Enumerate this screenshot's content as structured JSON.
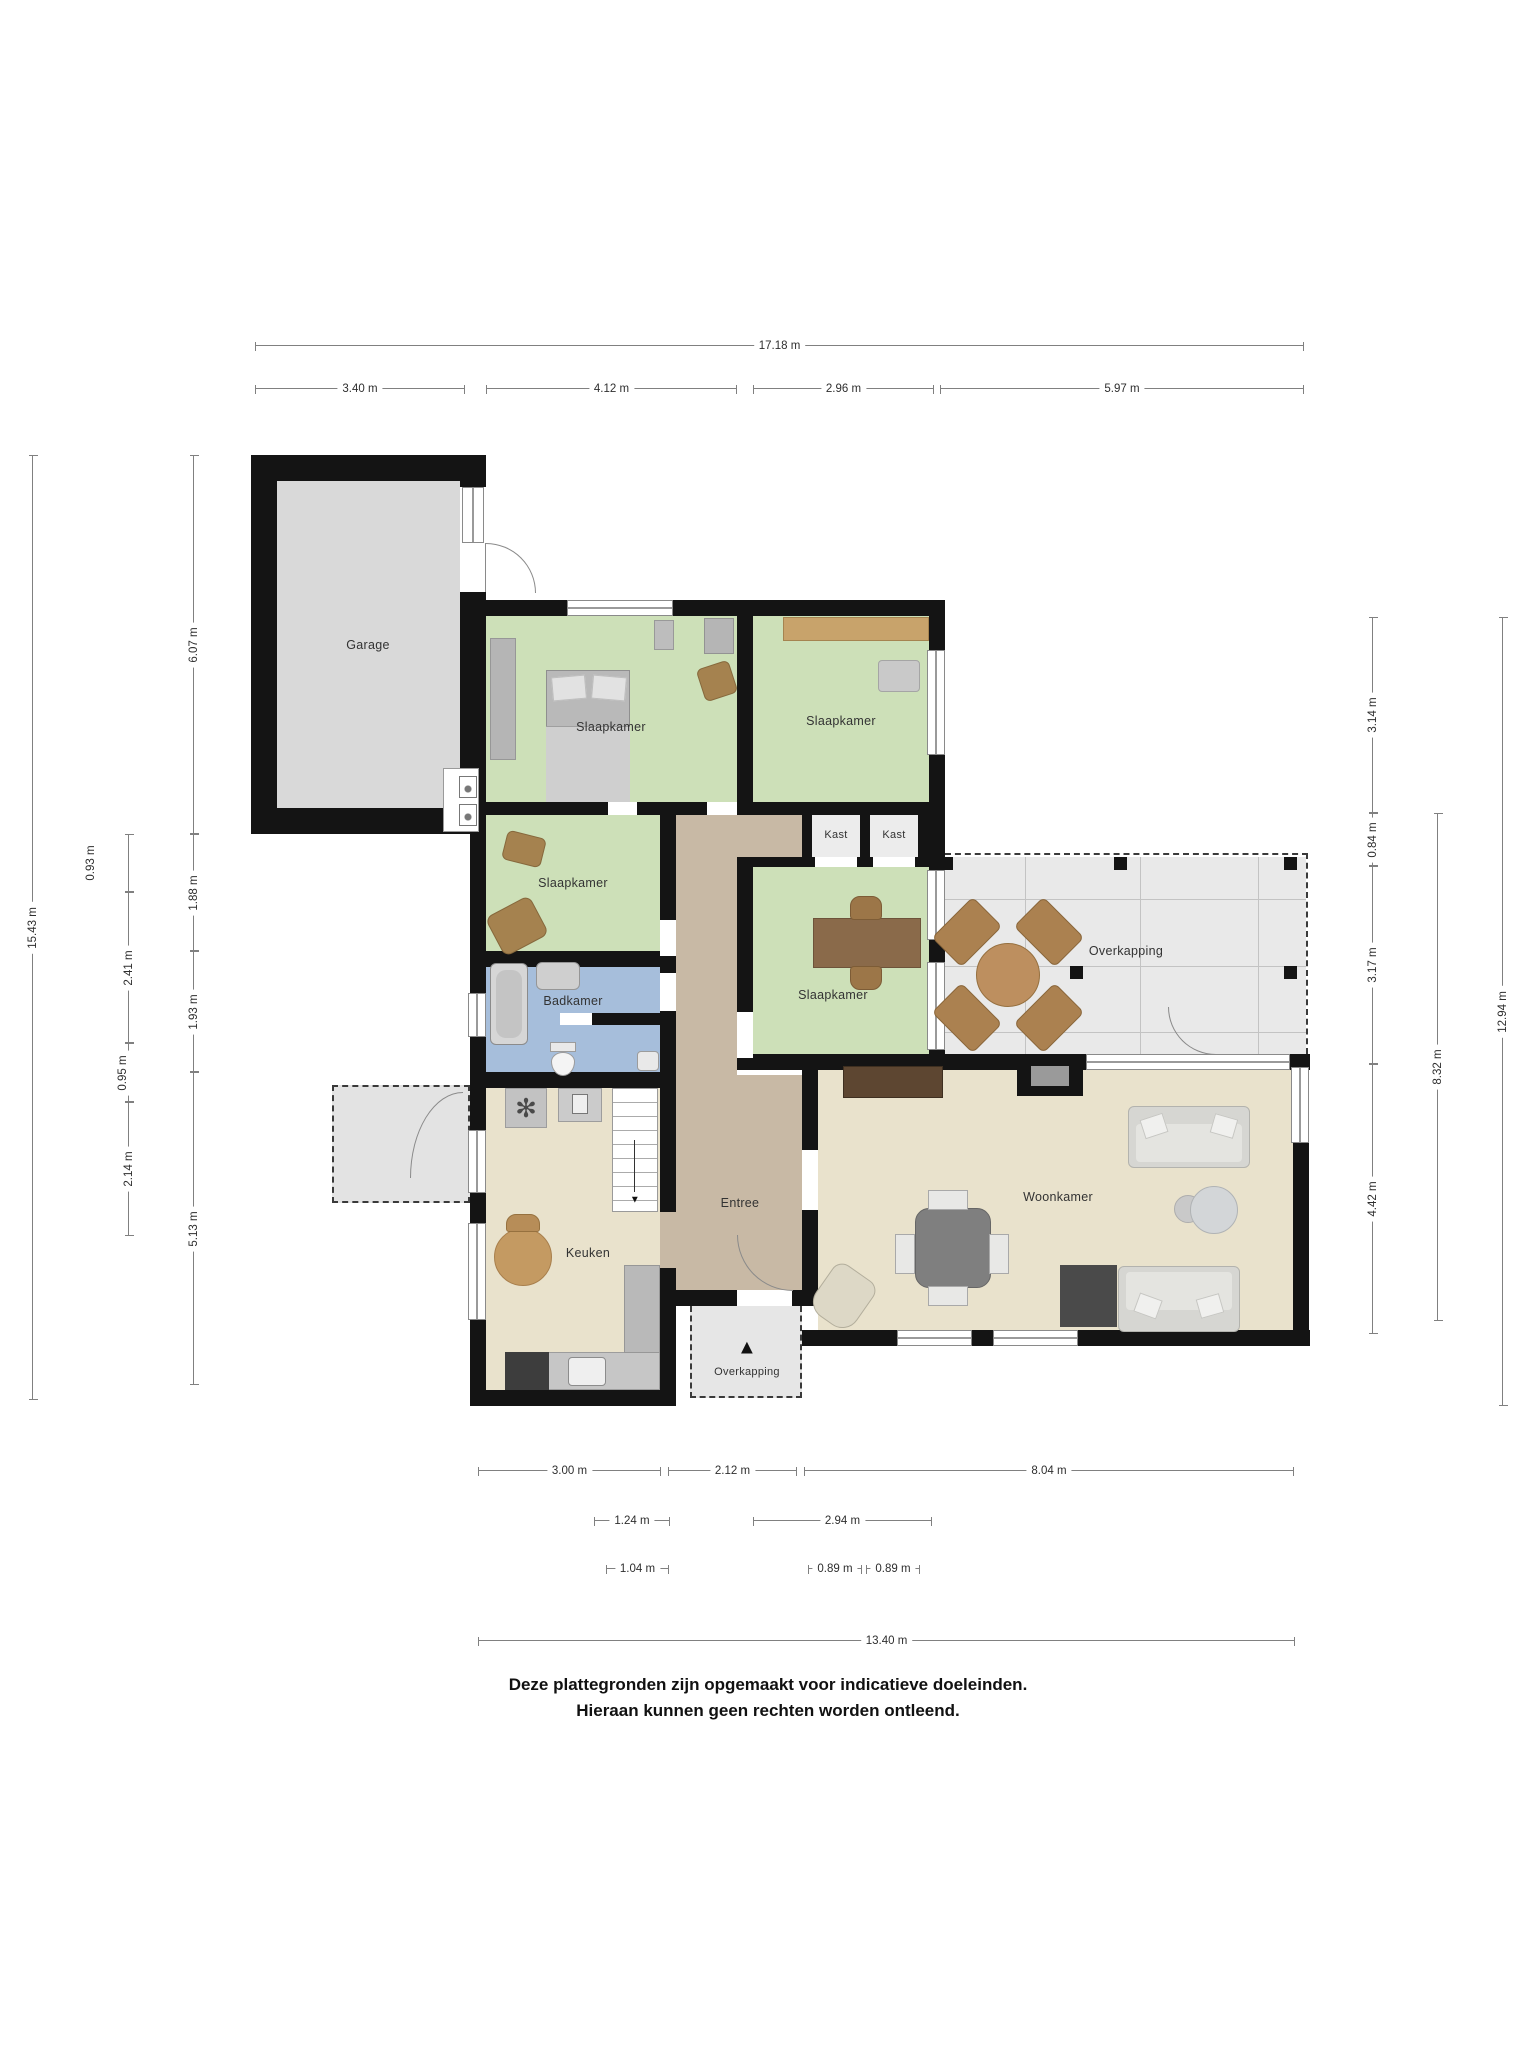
{
  "rooms": {
    "garage": {
      "label": "Garage"
    },
    "slaapkamer_1": {
      "label": "Slaapkamer"
    },
    "slaapkamer_2": {
      "label": "Slaapkamer"
    },
    "slaapkamer_3": {
      "label": "Slaapkamer"
    },
    "slaapkamer_4": {
      "label": "Slaapkamer"
    },
    "kast_1": {
      "label": "Kast"
    },
    "kast_2": {
      "label": "Kast"
    },
    "badkamer": {
      "label": "Badkamer"
    },
    "entree": {
      "label": "Entree"
    },
    "keuken": {
      "label": "Keuken"
    },
    "woonkamer": {
      "label": "Woonkamer"
    },
    "overkapping": {
      "label": "Overkapping"
    },
    "overkapping_entree": {
      "label": "Overkapping"
    }
  },
  "dims": {
    "top_total": "17.18 m",
    "top": [
      "3.40 m",
      "4.12 m",
      "2.96 m",
      "5.97 m"
    ],
    "left_outer": "15.43 m",
    "left_mid": [
      "0.93 m",
      "2.41 m",
      "0.95 m",
      "2.14 m"
    ],
    "left_inner": [
      "6.07 m",
      "1.88 m",
      "1.93 m",
      "5.13 m"
    ],
    "right_inner": [
      "3.14 m",
      "0.84 m",
      "3.17 m",
      "4.42 m"
    ],
    "right_mid": "8.32 m",
    "right_outer": "12.94 m",
    "bottom_row1": [
      "3.00 m",
      "2.12 m",
      "8.04 m"
    ],
    "bottom_row2": [
      "1.24 m",
      "2.94 m"
    ],
    "bottom_row3": [
      "1.04 m",
      "0.89 m",
      "0.89 m"
    ],
    "bottom_total": "13.40 m"
  },
  "icons": {
    "entrance_marker": "▲",
    "hob": "✻",
    "stairs_arrow": "▼"
  },
  "footer": {
    "line1": "Deze plattegronden zijn opgemaakt voor indicatieve doeleinden.",
    "line2": "Hieraan kunnen geen rechten worden ontleend."
  },
  "colors": {
    "wall": "#141414",
    "garage_floor": "#d9d9d9",
    "bedroom_floor": "#cde0b8",
    "bathroom_floor": "#a6bedb",
    "hall_floor": "#c8b9a5",
    "living_floor": "#e9e2cc",
    "closet_floor": "#ececec",
    "terrace_floor": "#e9e9e9",
    "wood": "#b98f5f",
    "dimension_line": "#808080"
  }
}
